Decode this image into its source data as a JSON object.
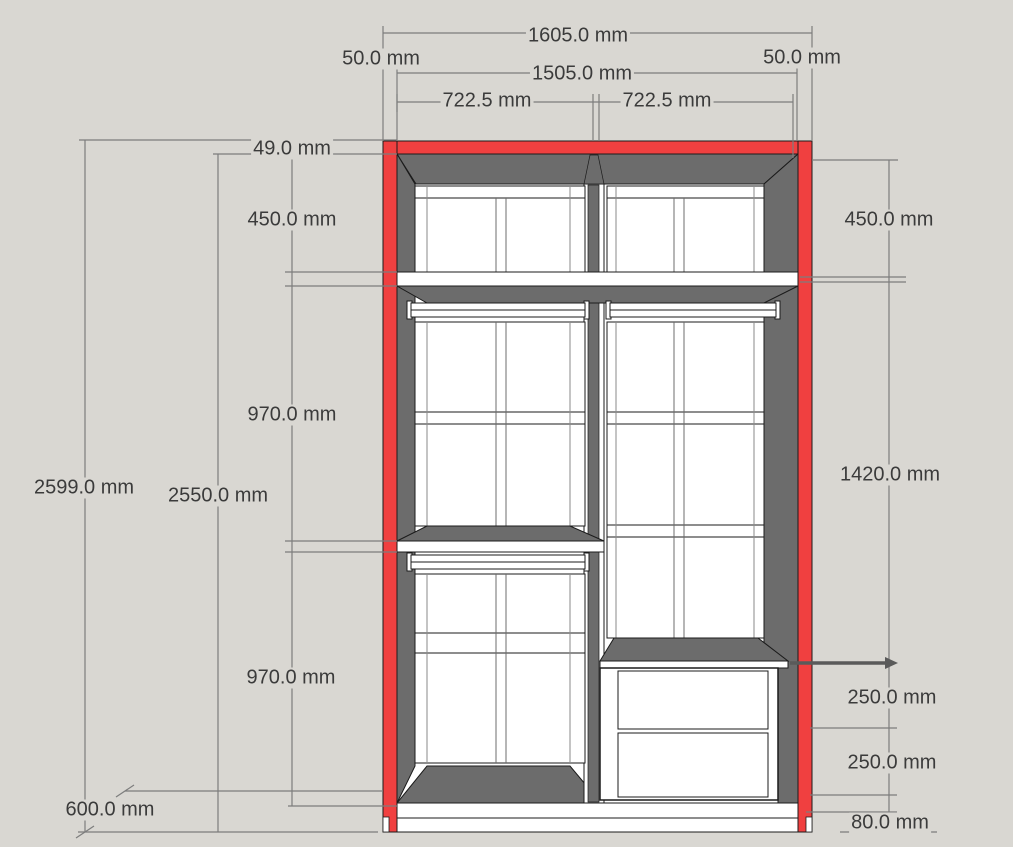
{
  "title": "Wardrobe elevation drawing with dimensions",
  "unit": "mm",
  "colors": {
    "background": "#d9d7d2",
    "frame_red": "#f04040",
    "interior_gray": "#6c6c6c",
    "panel_white": "#ffffff",
    "outline": "#1b1b1b",
    "dimension_line": "#7d7d7d",
    "dimension_text": "#3b3b3b"
  },
  "dimensions": {
    "top": {
      "overall_width": "1605.0 mm",
      "left_side_thickness": "50.0 mm",
      "right_side_thickness": "50.0 mm",
      "interior_width": "1505.0 mm",
      "left_bay_width": "722.5 mm",
      "right_bay_width": "722.5 mm"
    },
    "left": {
      "top_panel_thickness": "49.0 mm",
      "upper_section_height": "450.0 mm",
      "middle_section_height": "970.0 mm",
      "lower_section_height": "970.0 mm",
      "overall_height": "2599.0 mm",
      "carcass_height": "2550.0 mm",
      "depth": "600.0 mm"
    },
    "right": {
      "upper_section_height": "450.0 mm",
      "hanging_section_height": "1420.0 mm",
      "upper_drawer_height": "250.0 mm",
      "lower_drawer_height": "250.0 mm",
      "plinth_height": "80.0 mm"
    }
  }
}
